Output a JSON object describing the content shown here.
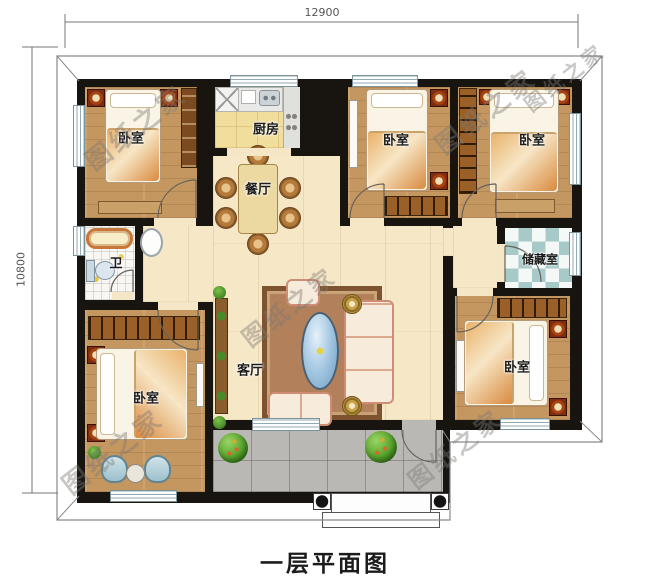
{
  "title": "一层平面图",
  "watermark_text": "图纸之家",
  "dimensions": {
    "top_width": "12900",
    "left_height": "10800"
  },
  "rooms": {
    "bedroom_top_left": "卧室",
    "bedroom_top_middle": "卧室",
    "bedroom_top_right": "卧室",
    "bedroom_bottom_left": "卧室",
    "bedroom_bottom_right": "卧室",
    "kitchen": "厨房",
    "dining": "餐厅",
    "living": "客厅",
    "bathroom": "卫",
    "storage": "储藏室"
  },
  "colors": {
    "wall": "#181410",
    "bedroom_floor": "#c49760",
    "open_floor": "#f6e7c6",
    "kitchen_floor": "#f1de9d",
    "patio_tile": "#b9b8b4",
    "storage_check": "#a7cac9",
    "window_frame": "#7d939b",
    "accent_orange": "#d98a3f"
  }
}
